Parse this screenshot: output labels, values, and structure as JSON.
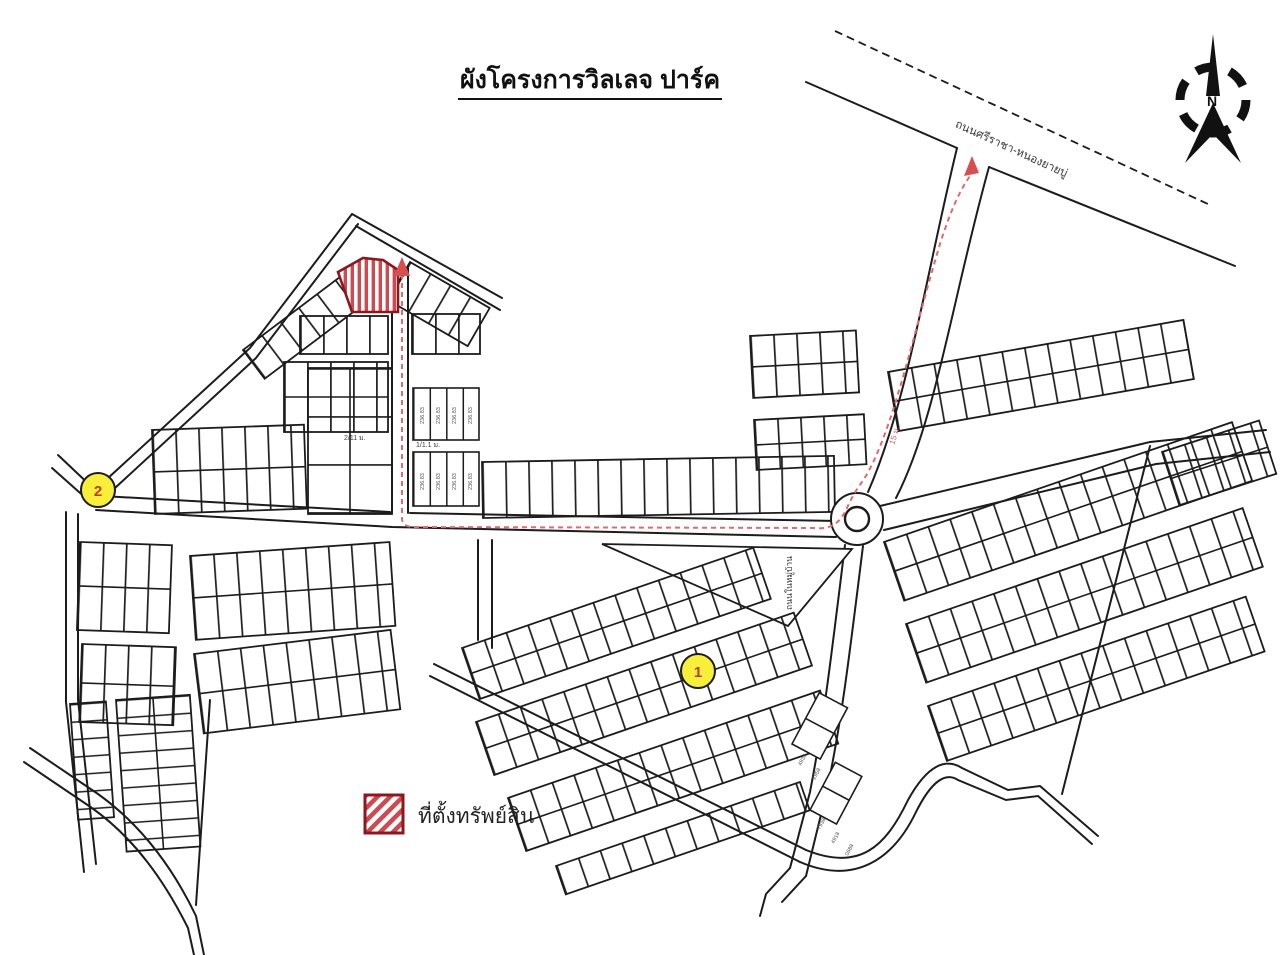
{
  "title": "ผังโครงการวิลเลจ ปาร์ค",
  "compass": {
    "north_label": "N"
  },
  "roads": {
    "highway": "ถนนศรีราชา-หนองยายบู่",
    "village_road": "ถนนในหมู่บ้าน",
    "access_road_width": "15 ม.",
    "soi_left": "2/11 ม.",
    "soi_right": "1/1.1 ม."
  },
  "markers": {
    "marker1": "1",
    "marker2": "2"
  },
  "legend": {
    "property_label": "ที่ตั้งทรัพย์สิน"
  },
  "lots": {
    "upper": [
      "236.83",
      "236.83",
      "236.83",
      "236.83"
    ],
    "lower": [
      "236.83",
      "236.83",
      "236.83",
      "236.83"
    ],
    "strips": [
      "4936",
      "2958",
      "7938",
      "4918",
      "0688"
    ]
  },
  "colors": {
    "route": "#e06b6b",
    "marker_fill": "#f8ef3a",
    "marker_text": "#c03a2b",
    "hatch": "#cf4950",
    "hatch_border": "#8c181d",
    "line": "#1c1c1c"
  }
}
